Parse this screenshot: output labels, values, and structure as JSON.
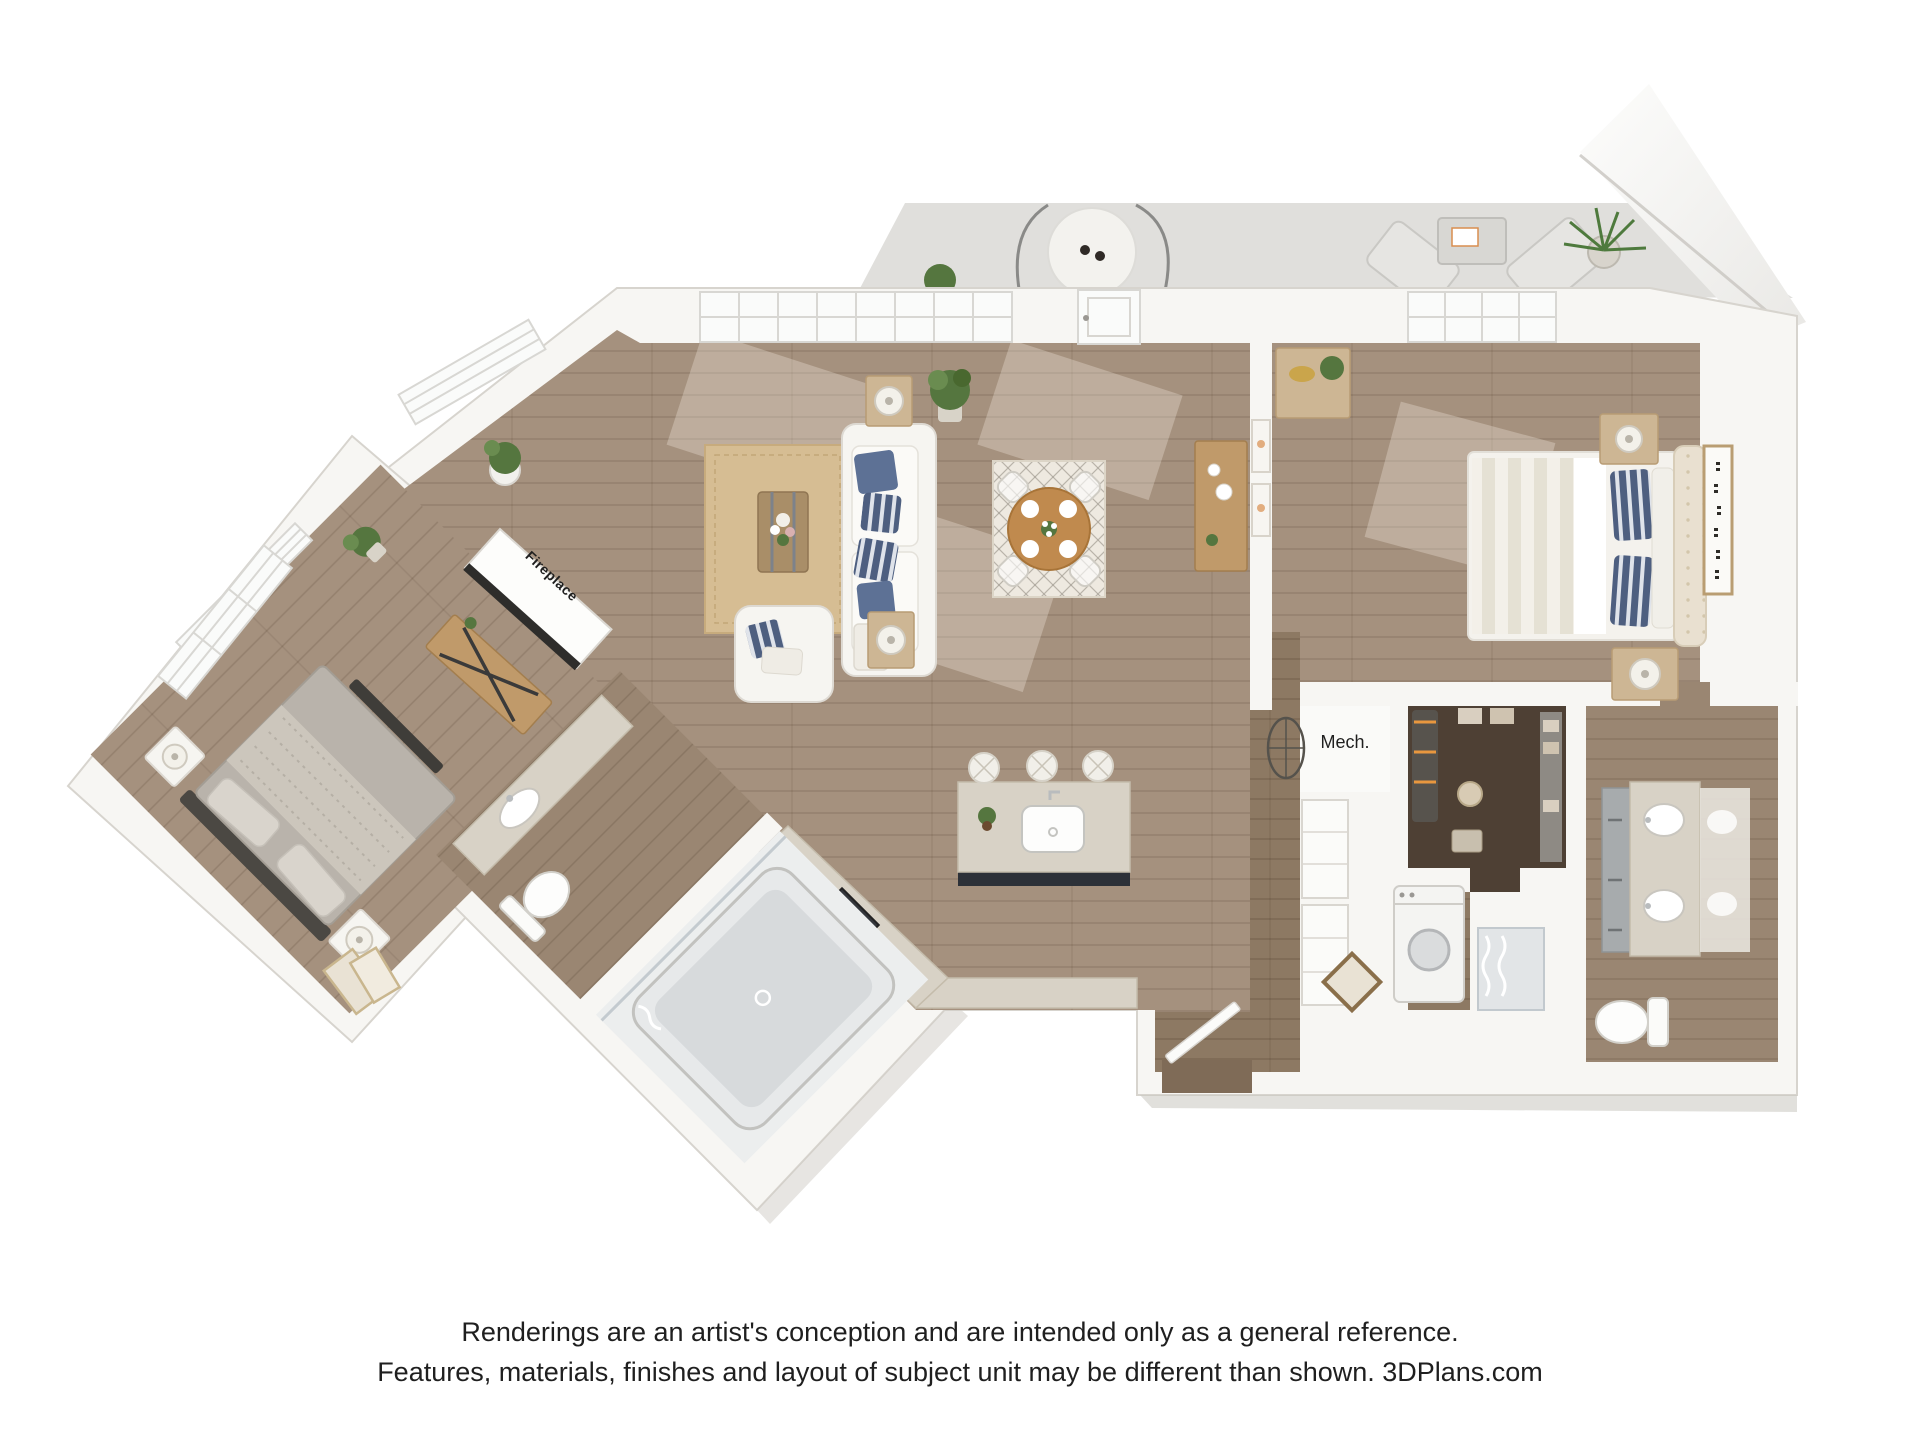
{
  "labels": {
    "fireplace": "Fireplace",
    "mech": "Mech."
  },
  "disclaimer": {
    "line1": "Renderings are an artist's conception and are intended only as a general reference.",
    "line2": "Features, materials, finishes and layout of subject unit may be different than shown. 3DPlans.com"
  },
  "colors": {
    "wall": "#f7f6f3",
    "wallEdge": "#d7d4ce",
    "patio": "#e0dfdc",
    "floor": "#a5917e",
    "floorDark": "#8d7963",
    "floorEntry": "#7f6b57",
    "floorCloset": "#4e4034",
    "floorBath": "#9a8672",
    "granite": "#d8d2c6",
    "graniteEdge": "#c4bcab",
    "islandBase": "#2d3138",
    "wood": "#c09a6a",
    "woodLight": "#cdb694",
    "woodDark": "#a98e68",
    "navy": "#5d7195",
    "bedGray": "#b9b3ab",
    "headboard": "#e9e0d0",
    "green": "#55763f",
    "rugJute": "#d6bd93",
    "rugCream": "#eee9e0",
    "textDark": "#1f1f1f"
  }
}
